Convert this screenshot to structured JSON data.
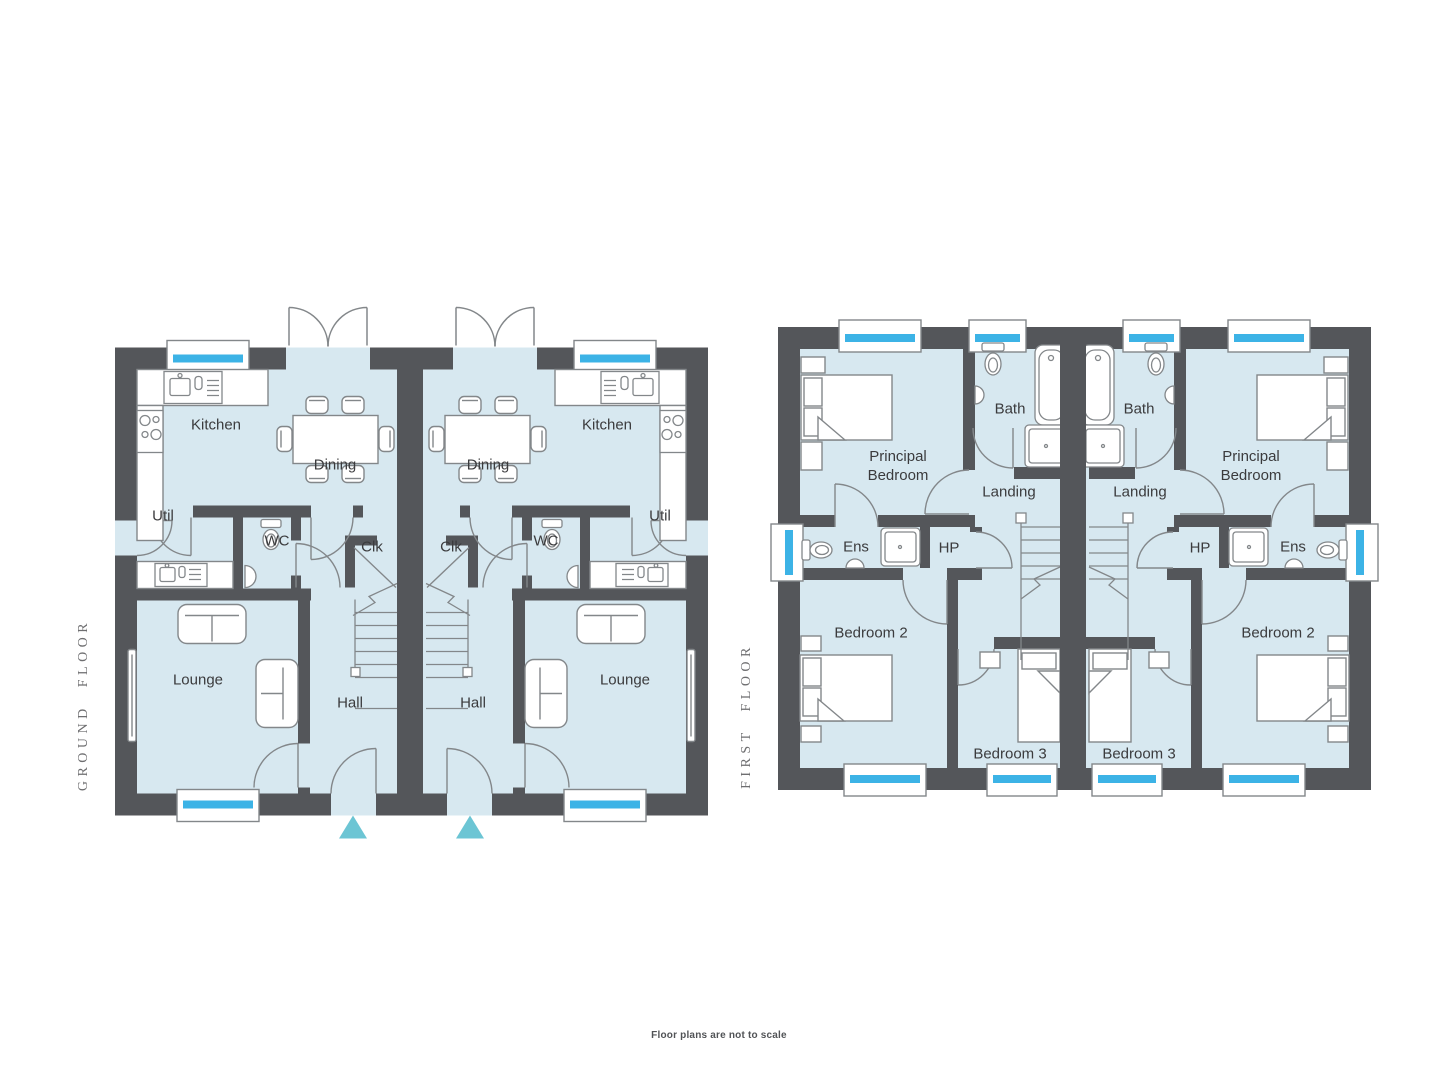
{
  "page": {
    "footnote": "Floor plans are not to scale",
    "background": "#ffffff"
  },
  "palette": {
    "room_fill": "#d7e8f0",
    "wall": "#54565a",
    "outline": "#83878a",
    "window_accent": "#3cb3e6",
    "entrance_marker": "#6cc5d4",
    "room_label": "#3b3b3d",
    "floor_title": "#6e6e70",
    "footnote_color": "#515356"
  },
  "ground_floor": {
    "title": "GROUND FLOOR",
    "rooms": {
      "kitchen": "Kitchen",
      "dining": "Dining",
      "util": "Util",
      "wc": "WC",
      "clk": "Clk",
      "lounge": "Lounge",
      "hall": "Hall"
    }
  },
  "first_floor": {
    "title": "FIRST FLOOR",
    "rooms": {
      "principal_bedroom": "Principal Bedroom",
      "bath": "Bath",
      "landing": "Landing",
      "ens": "Ens",
      "hp": "HP",
      "bedroom_2": "Bedroom 2",
      "bedroom_3": "Bedroom 3"
    }
  }
}
